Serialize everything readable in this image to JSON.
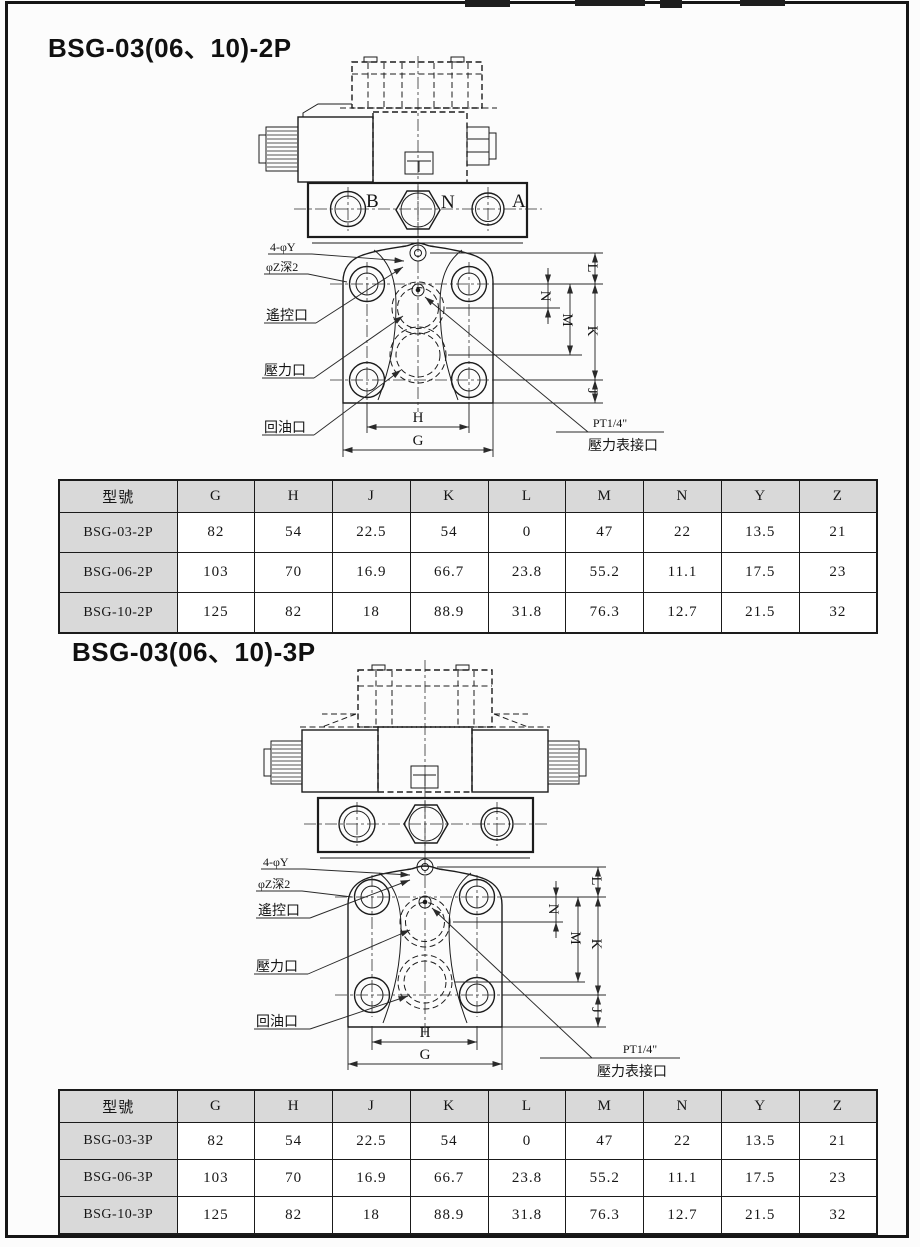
{
  "page": {
    "s1": {
      "title": "BSG-03(06、10)-2P",
      "drawing": {
        "port_b": "B",
        "port_n": "N",
        "port_a": "A",
        "callout_holes": "4-φY",
        "callout_depth": "φZ深2",
        "callout_remote": "遙控口",
        "callout_pressure": "壓力口",
        "callout_return": "回油口",
        "gauge_thread": "PT1/4\"",
        "gauge_label": "壓力表接口",
        "dim_h": "H",
        "dim_g": "G",
        "dim_l": "L",
        "dim_n": "N",
        "dim_m": "M",
        "dim_k": "K",
        "dim_j": "J"
      },
      "table": {
        "headers": [
          "型號",
          "G",
          "H",
          "J",
          "K",
          "L",
          "M",
          "N",
          "Y",
          "Z"
        ],
        "rows": [
          [
            "BSG-03-2P",
            "82",
            "54",
            "22.5",
            "54",
            "0",
            "47",
            "22",
            "13.5",
            "21"
          ],
          [
            "BSG-06-2P",
            "103",
            "70",
            "16.9",
            "66.7",
            "23.8",
            "55.2",
            "11.1",
            "17.5",
            "23"
          ],
          [
            "BSG-10-2P",
            "125",
            "82",
            "18",
            "88.9",
            "31.8",
            "76.3",
            "12.7",
            "21.5",
            "32"
          ]
        ]
      }
    },
    "s2": {
      "title": "BSG-03(06、10)-3P",
      "drawing": {
        "callout_holes": "4-φY",
        "callout_depth": "φZ深2",
        "callout_remote": "遙控口",
        "callout_pressure": "壓力口",
        "callout_return": "回油口",
        "gauge_thread": "PT1/4\"",
        "gauge_label": "壓力表接口",
        "dim_h": "H",
        "dim_g": "G",
        "dim_l": "L",
        "dim_n": "N",
        "dim_m": "M",
        "dim_k": "K",
        "dim_j": "J"
      },
      "table": {
        "headers": [
          "型號",
          "G",
          "H",
          "J",
          "K",
          "L",
          "M",
          "N",
          "Y",
          "Z"
        ],
        "rows": [
          [
            "BSG-03-3P",
            "82",
            "54",
            "22.5",
            "54",
            "0",
            "47",
            "22",
            "13.5",
            "21"
          ],
          [
            "BSG-06-3P",
            "103",
            "70",
            "16.9",
            "66.7",
            "23.8",
            "55.2",
            "11.1",
            "17.5",
            "23"
          ],
          [
            "BSG-10-3P",
            "125",
            "82",
            "18",
            "88.9",
            "31.8",
            "76.3",
            "12.7",
            "21.5",
            "32"
          ]
        ]
      }
    }
  }
}
